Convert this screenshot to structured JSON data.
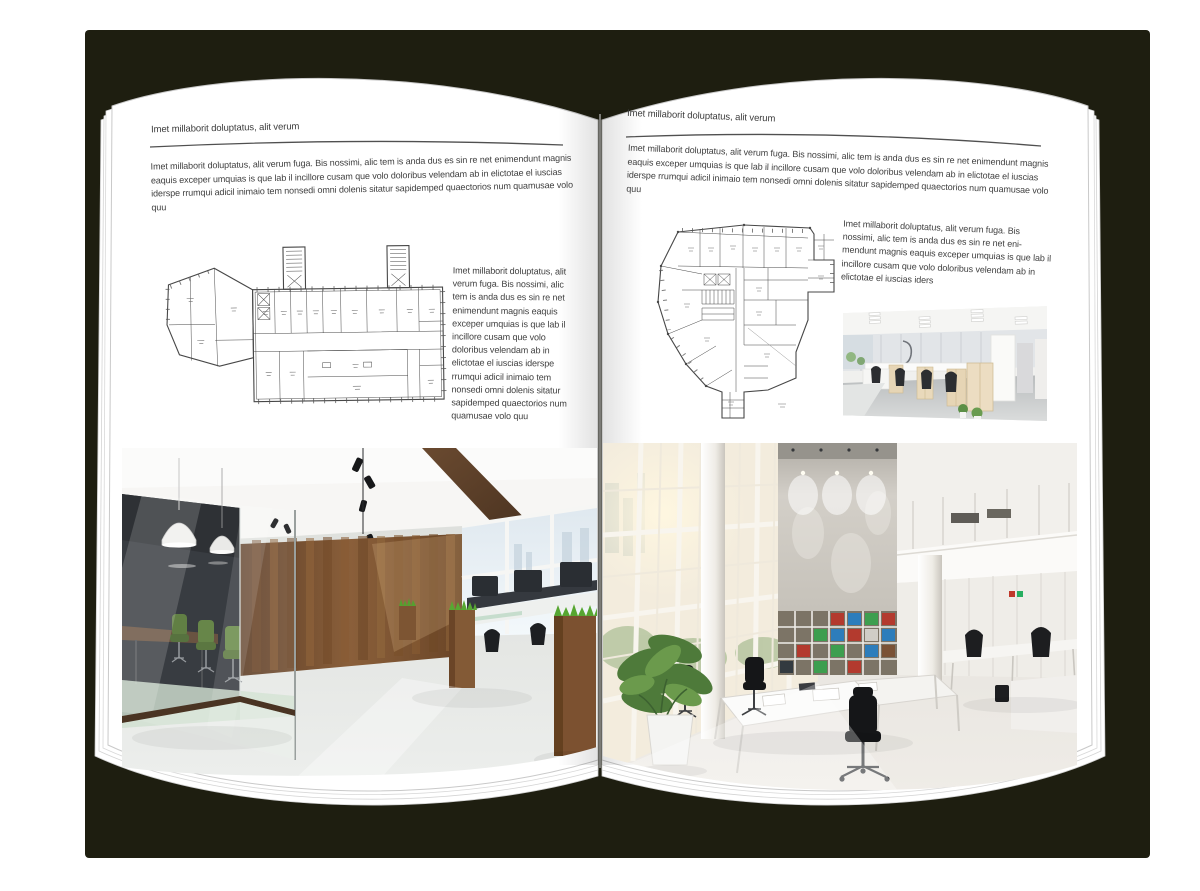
{
  "canvas": {
    "backdrop_color": "#1e1e10",
    "page_color": "#ffffff",
    "text_color": "#3f3f3f",
    "rule_color": "#505050"
  },
  "left_page": {
    "header": "Imet millaborit doluptatus, alit verum",
    "intro": "Imet millaborit doluptatus, alit verum fuga. Bis nossimi, alic tem is anda dus es sin re net enimendunt magnis eaquis exceper umquias is que lab il incillore cusam que volo doloribus velendam ab in elictotae el iuscias iderspe rrumqui adicil inimaio tem nonsedi omni dolenis sitatur sapidemped quaectorios num quamusae volo quu",
    "caption": "Imet millaborit doluptatus, alit verum fuga. Bis nossimi, alic tem is anda dus es sin re net enimendunt magnis eaquis exceper umquias is que lab il incillore cusam que volo doloribus velendam ab in elictotae el iuscias iderspe rrumqui adicil inimaio tem nonsedi omni dolenis sitatur sapidemped quaectorios num quamusae volo quu"
  },
  "right_page": {
    "header": "Imet millaborit doluptatus, alit verum",
    "intro": "Imet millaborit doluptatus, alit verum fuga. Bis nossimi, alic tem is anda dus es sin re net enimendunt magnis eaquis exceper umquias is que lab il incillore cusam que volo doloribus velendam ab in elictotae el iuscias iderspe rrumqui adicil inimaio tem nonsedi omni dolenis sitatur sapidemped quaectorios num quamusae volo quu",
    "caption": "Imet millaborit doluptatus, alit verum fuga. Bis nossimi, alic tem is anda dus es sin re net eni-mendunt magnis eaquis exceper umquias is que lab il incillore cusam que volo doloribus velendam ab in elictotae el iuscias iders"
  }
}
